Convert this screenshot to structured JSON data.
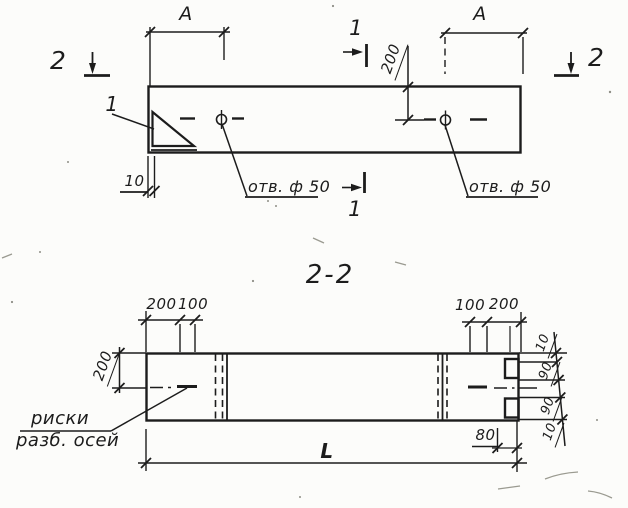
{
  "colors": {
    "ink": "#1c1c1c",
    "paper": "#fcfcfa"
  },
  "top_view": {
    "dim_a_left": "A",
    "dim_a_right": "A",
    "dim_200": "200",
    "dim_10": "10",
    "hole_label_left": "отв. ф 50",
    "hole_label_right": "отв. ф 50",
    "cut_mark_1_top": "1",
    "cut_mark_1_bottom": "1",
    "cut_mark_2_left": "2",
    "cut_mark_2_right": "2",
    "detail_label": "1"
  },
  "section_view": {
    "title": "2-2",
    "dim_200_left_top": "200",
    "dim_100_left_top": "100",
    "dim_100_right_top": "100",
    "dim_200_right_top": "200",
    "dim_200_side": "200",
    "dim_right_stack": [
      "10",
      "90",
      "90",
      "10"
    ],
    "dim_80": "80",
    "dim_length": "L",
    "note_line1": "риски",
    "note_line2": "разб. осей"
  }
}
